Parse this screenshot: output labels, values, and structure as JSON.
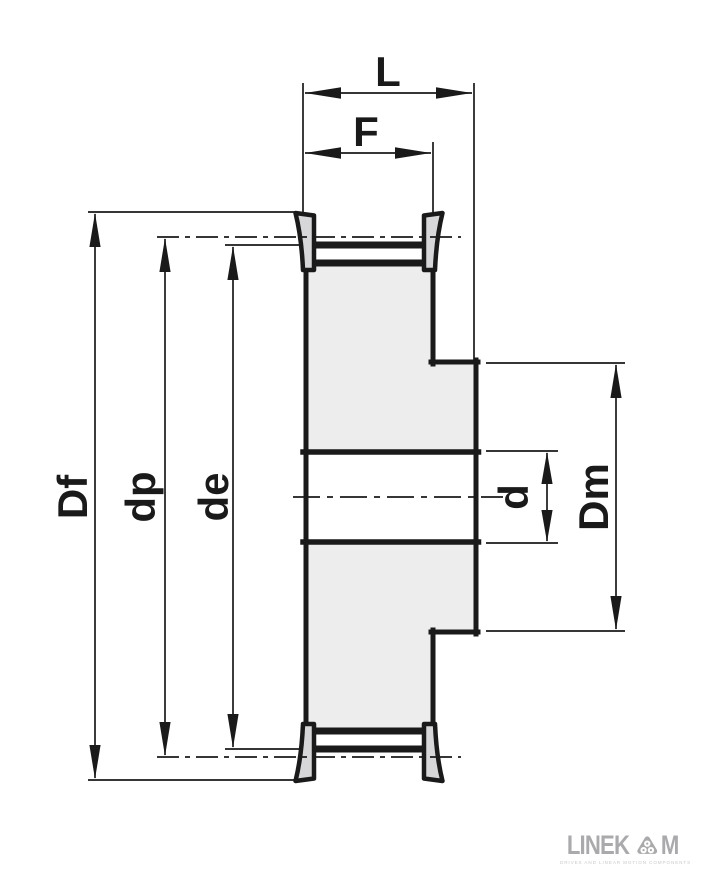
{
  "dims": {
    "L": "L",
    "F": "F",
    "Df": "Df",
    "dp": "dp",
    "de": "de",
    "d": "d",
    "Dm": "Dm"
  },
  "colors": {
    "line": "#1a1a1a",
    "body_fill": "#ededee",
    "flange_fill": "#d7d7d9",
    "logo_gray": "#aaaaad"
  },
  "logo": {
    "wordmark_left": "LINEK",
    "wordmark_right": "M",
    "brand": "LINEKOM",
    "tagline": "DRIVES AND LINEAR MOTION COMPONENTS"
  }
}
